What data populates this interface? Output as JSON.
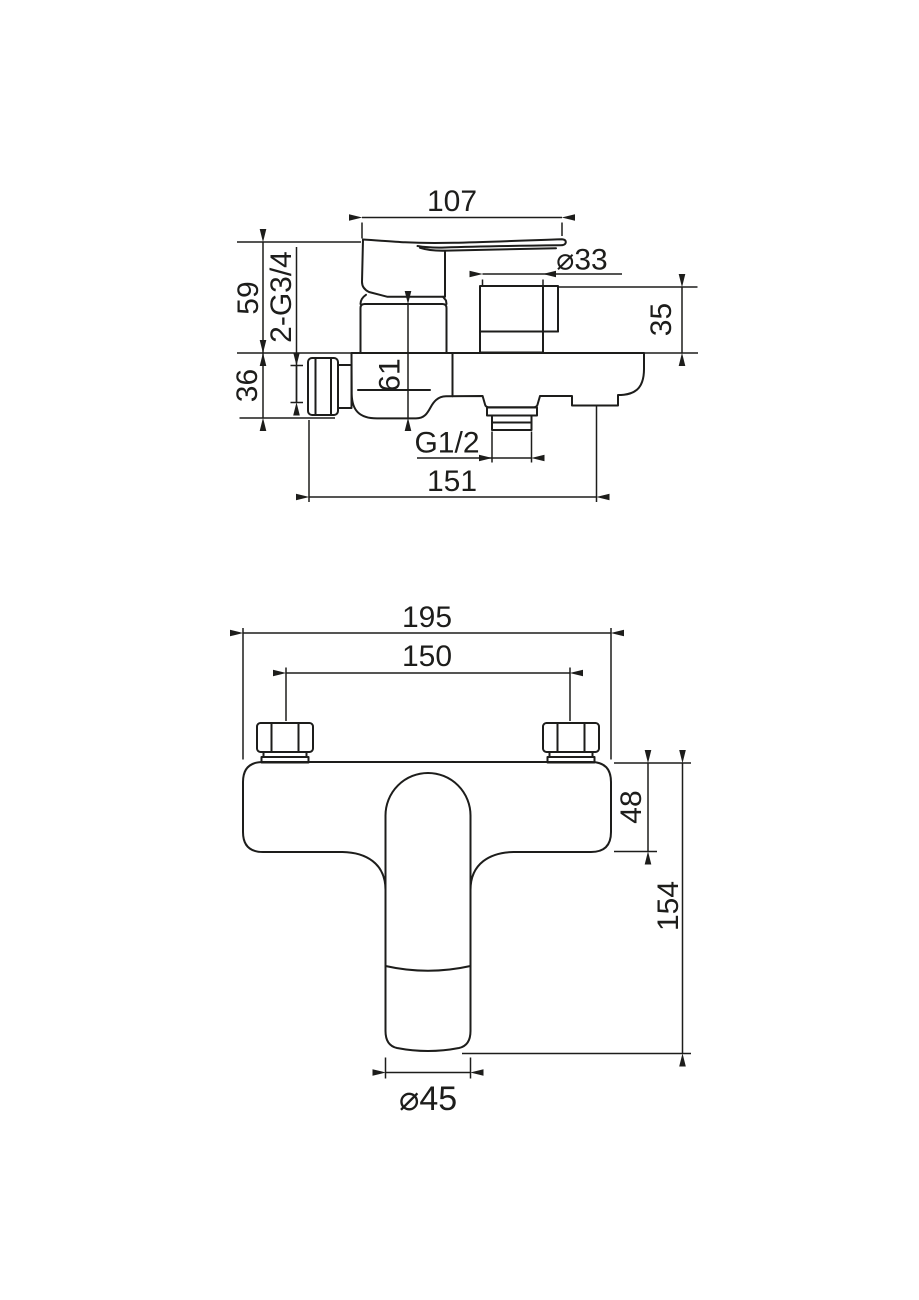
{
  "canvas": {
    "width": 919,
    "height": 1300,
    "background": "#ffffff",
    "line_color": "#1d1d1b"
  },
  "side_view": {
    "dims": {
      "handle_length": "107",
      "shower_port_diameter": "⌀33",
      "upper_height": "59",
      "shower_thread": "2-G3/4",
      "lower_height": "36",
      "body_height": "61",
      "port_height": "35",
      "bottom_thread": "G1/2",
      "overall_depth": "151"
    }
  },
  "front_view": {
    "dims": {
      "overall_width": "195",
      "mounting_centers": "150",
      "body_depth": "48",
      "overall_height": "154",
      "spout_diameter": "⌀45"
    }
  }
}
